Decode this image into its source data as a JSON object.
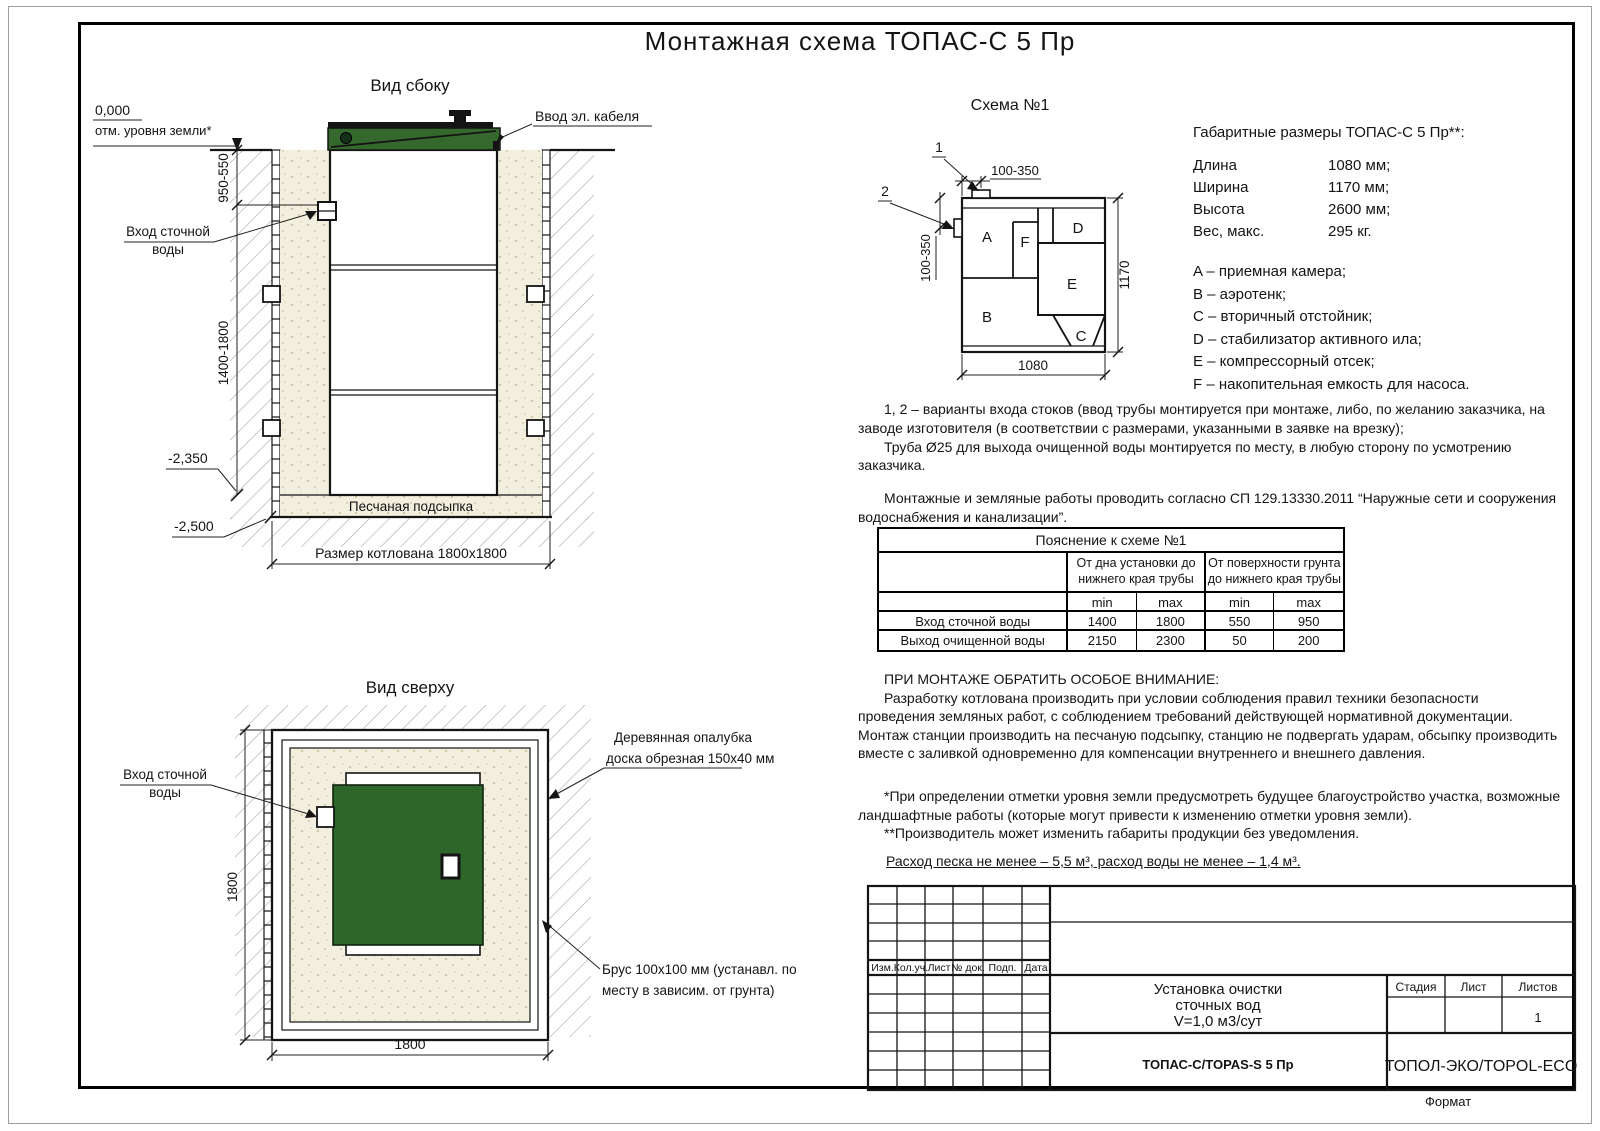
{
  "title": "Монтажная схема ТОПАС-С 5 Пр",
  "side": {
    "title": "Вид сбоку",
    "zero": "0,000",
    "ground": "отм. уровня земли*",
    "dim_upper": "950-550",
    "dim_lower": "1400-1800",
    "level1": "-2,350",
    "level2": "-2,500",
    "inlet_line1": "Вход сточной",
    "inlet_line2": "воды",
    "cable": "Ввод эл. кабеля",
    "sand": "Песчаная подсыпка",
    "pit": "Размер котлована 1800х1800"
  },
  "top": {
    "title": "Вид сверху",
    "inlet_line1": "Вход сточной",
    "inlet_line2": "воды",
    "formwork_line1": "Деревянная опалубка",
    "formwork_line2": "доска обрезная 150х40 мм",
    "beam_line1": "Брус 100х100 мм (устанавл. по",
    "beam_line2": "месту в зависим. от грунта)",
    "dim_v": "1800",
    "dim_h": "1800"
  },
  "schema": {
    "title": "Схема №1",
    "marker1": "1",
    "marker2": "2",
    "dim_top": "100-350",
    "dim_left": "100-350",
    "dim_width": "1080",
    "dim_height": "1170",
    "a": "A",
    "b": "B",
    "c": "C",
    "d": "D",
    "e": "E",
    "f": "F"
  },
  "specs": {
    "heading": "Габаритные размеры ТОПАС-С 5 Пр**:",
    "rows": [
      {
        "label": "Длина",
        "value": "1080 мм;"
      },
      {
        "label": "Ширина",
        "value": "1170 мм;"
      },
      {
        "label": "Высота",
        "value": "2600 мм;"
      },
      {
        "label": "Вес, макс.",
        "value": "295 кг."
      }
    ],
    "legend": [
      "A – приемная камера;",
      "B – аэротенк;",
      "C – вторичный отстойник;",
      "D – стабилизатор активного ила;",
      "E – компрессорный отсек;",
      "F – накопительная емкость для насоса."
    ]
  },
  "notes": {
    "p1": "1, 2 – варианты входа стоков (ввод трубы монтируется при монтаже, либо, по желанию заказчика, на заводе изготовителя (в соответствии с размерами, указанными в заявке на врезку);",
    "p2": "Труба Ø25 для выхода очищенной воды монтируется по месту, в любую сторону по усмотрению заказчика.",
    "p3": "Монтажные и земляные работы проводить согласно СП 129.13330.2011 “Наружные сети и сооружения водоснабжения и канализации”."
  },
  "table": {
    "title": "Пояснение к схеме №1",
    "group1": "От дна установки до нижнего края трубы",
    "group2": "От поверхности грунта до нижнего края трубы",
    "min": "min",
    "max": "max",
    "rows": [
      {
        "label": "Вход сточной воды",
        "c": [
          "1400",
          "1800",
          "550",
          "950"
        ]
      },
      {
        "label": "Выход очищенной воды",
        "c": [
          "2150",
          "2300",
          "50",
          "200"
        ]
      }
    ]
  },
  "attention": {
    "heading": "ПРИ МОНТАЖЕ ОБРАТИТЬ ОСОБОЕ ВНИМАНИЕ:",
    "body": "Разработку котлована производить при условии соблюдения правил техники безопасности проведения земляных работ, с соблюдением требований действующей нормативной документации. Монтаж станции производить на песчаную подсыпку, станцию не подвергать ударам, обсыпку производить вместе с заливкой одновременно для компенсации внутреннего и внешнего давления."
  },
  "footnotes": {
    "f1": "*При определении отметки уровня земли предусмотреть будущее благоустройство участка, возможные ландшафтные работы (которые могут привести к изменению отметки уровня земли).",
    "f2": "**Производитель может изменить габариты продукции без уведомления."
  },
  "consumption": "Расход песка не менее – 5,5 м³, расход воды не менее – 1,4 м³.",
  "stamp": {
    "cols": [
      "Изм.",
      "Кол.уч.",
      "Лист",
      "№ док.",
      "Подп.",
      "Дата"
    ],
    "doc1": "Установка очистки",
    "doc2": "сточных вод",
    "doc3": "V=1,0 м3/сут",
    "stage": "Стадия",
    "sheet": "Лист",
    "sheets": "Листов",
    "sheets_value": "1",
    "model": "ТОПАС-С/TOPAS-S 5 Пр",
    "company": "ТОПОЛ-ЭКО/TOPOL-ECO",
    "format_label": "Формат",
    "format_value": "А3"
  },
  "colors": {
    "lid_green": "#35682c",
    "tank_green": "#2e662a",
    "sand": "#f2efde",
    "line": "#141414"
  }
}
